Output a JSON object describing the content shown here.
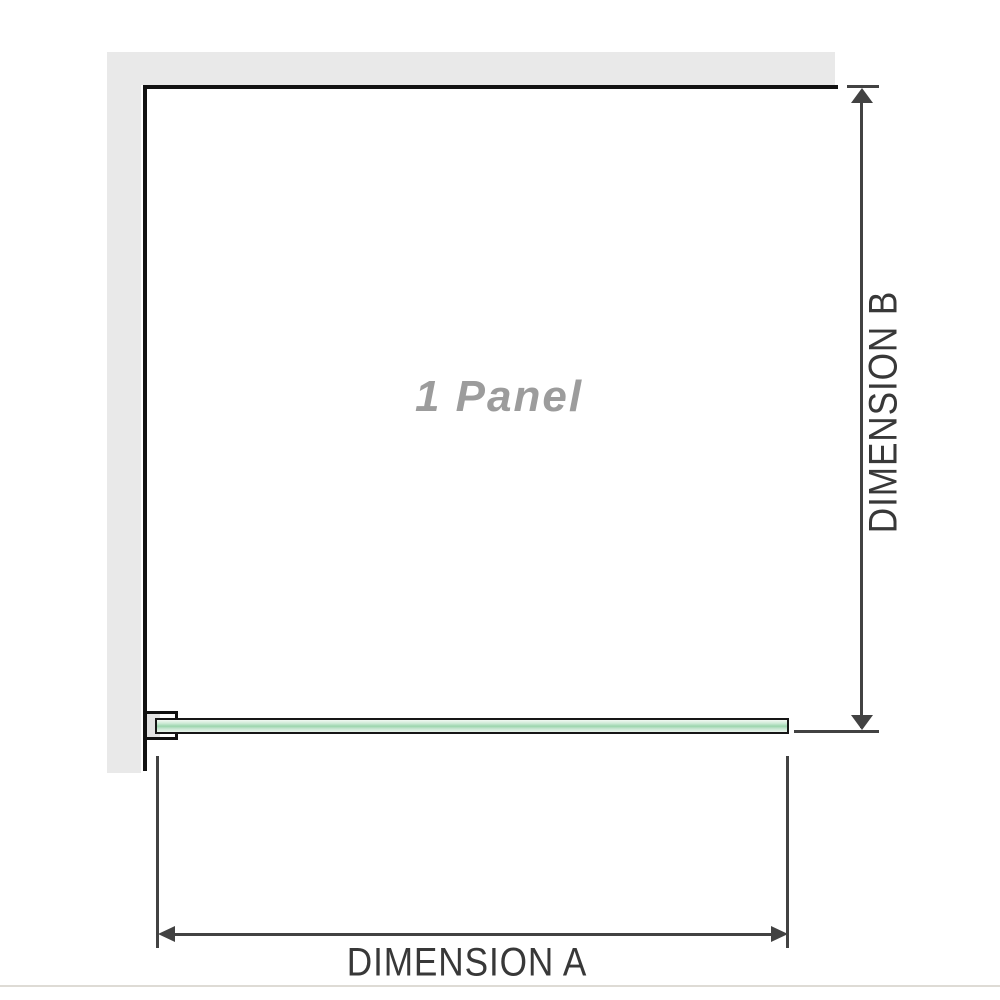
{
  "diagram": {
    "title": "1 panel shower screen dimension diagram",
    "panel_label": "1 Panel",
    "dimension_a_label": "DIMENSION A",
    "dimension_b_label": "DIMENSION B"
  },
  "colors": {
    "wall_gray": "#e9e9e9",
    "outline_black": "#121212",
    "dimension_line_gray": "#424242",
    "dimension_text_gray": "#383838",
    "panel_label_gray": "#9c9c9c",
    "glass_green": "#9bd5ad",
    "glass_green_light": "#f2f8f3",
    "bracket_pad_gray": "#e2e2e2",
    "base_line_gray": "#dedbd5"
  }
}
